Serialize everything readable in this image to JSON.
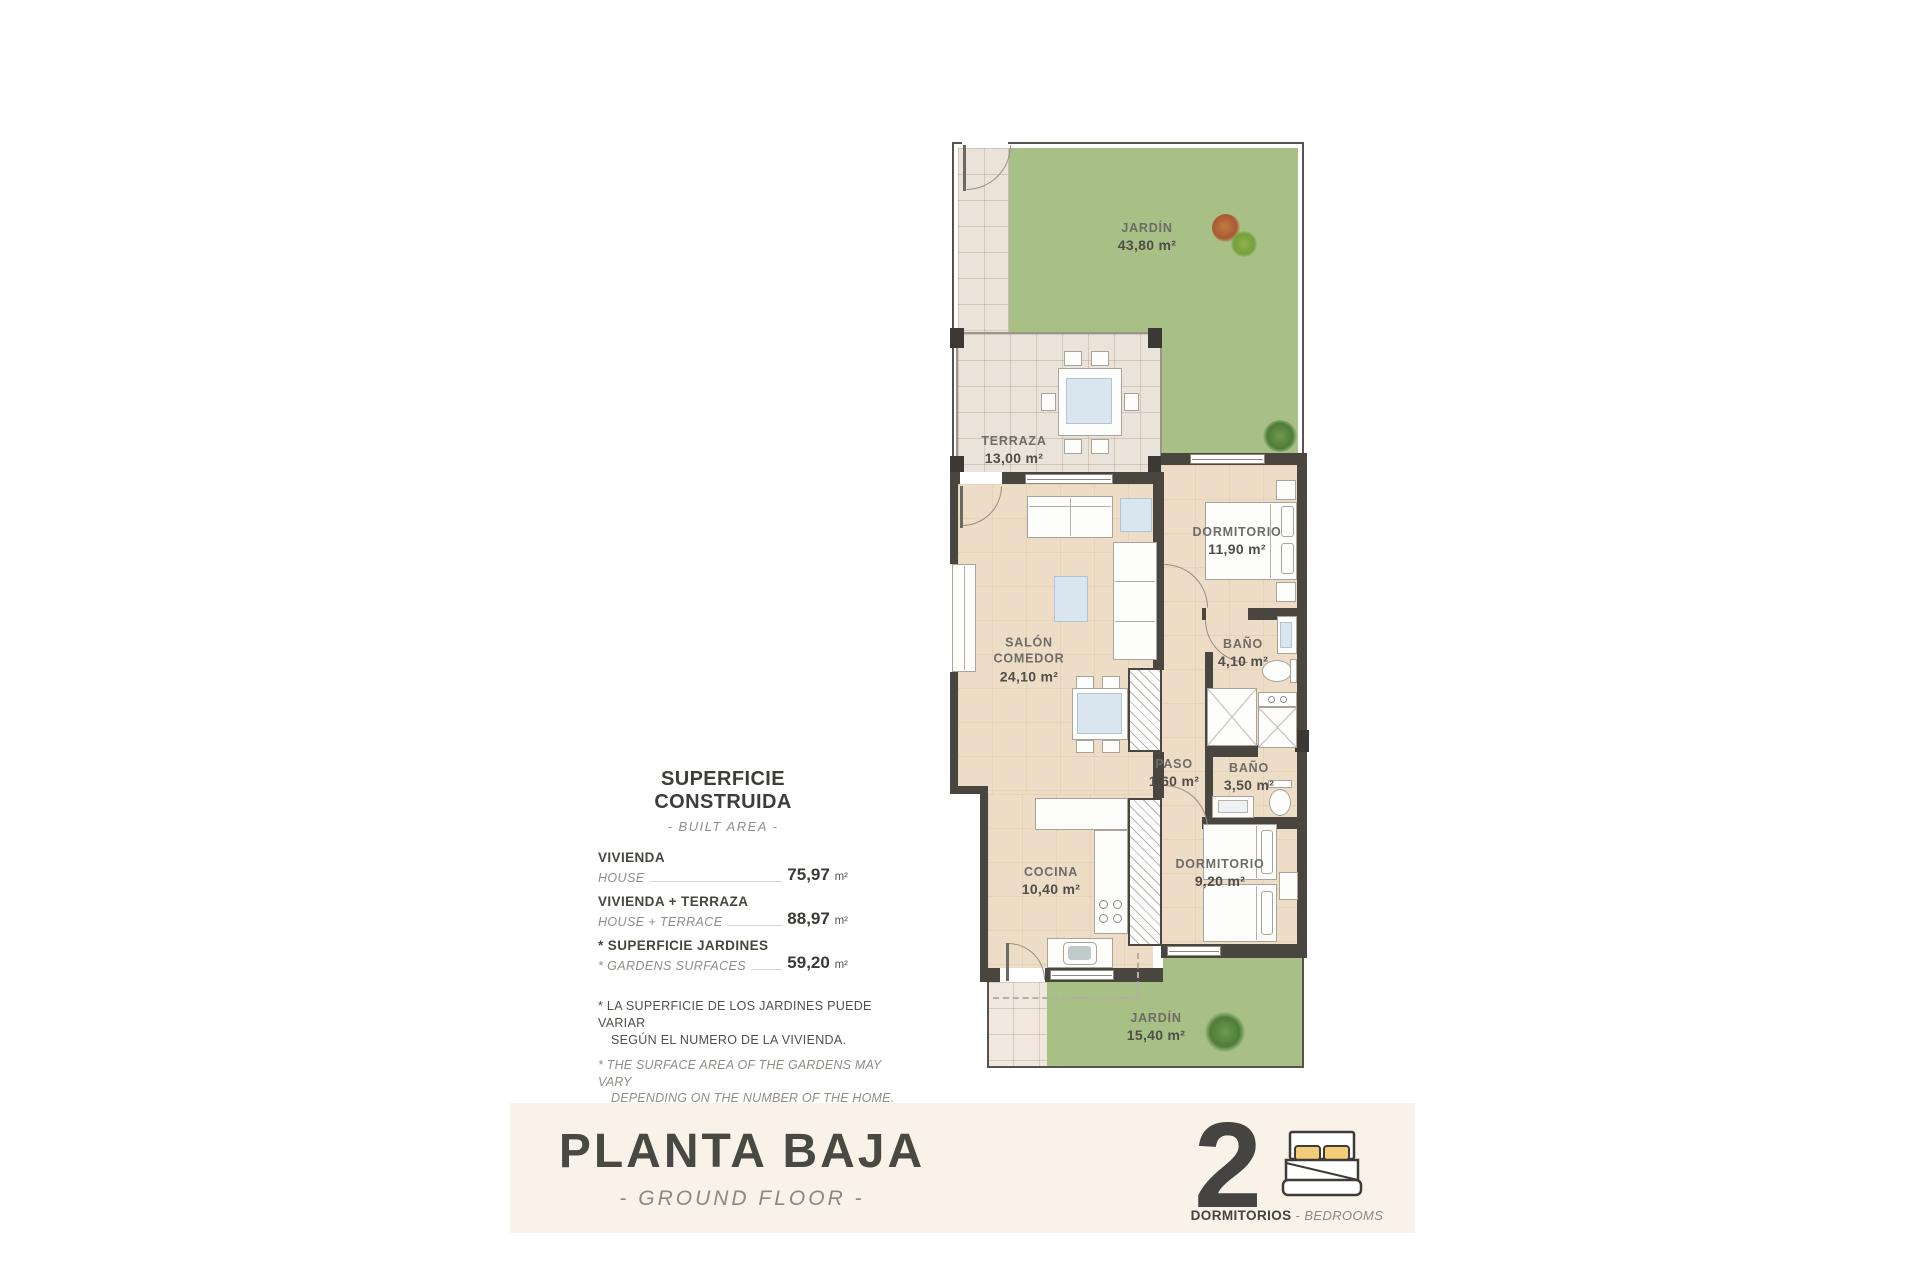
{
  "plan": {
    "rooms": {
      "jardin_top": {
        "name": "JARDÍN",
        "area": "43,80 m²"
      },
      "terraza": {
        "name": "TERRAZA",
        "area": "13,00 m²"
      },
      "salon": {
        "line1": "SALÓN",
        "line2": "COMEDOR",
        "area": "24,10 m²"
      },
      "dormitorio1": {
        "name": "DORMITORIO",
        "area": "11,90 m²"
      },
      "bano1": {
        "name": "BAÑO",
        "area": "4,10 m²"
      },
      "paso": {
        "name": "PASO",
        "area": "1,60 m²"
      },
      "bano2": {
        "name": "BAÑO",
        "area": "3,50 m²"
      },
      "cocina": {
        "name": "COCINA",
        "area": "10,40 m²"
      },
      "dormitorio2": {
        "name": "DORMITORIO",
        "area": "9,20 m²"
      },
      "jardin_bottom": {
        "name": "JARDÍN",
        "area": "15,40 m²"
      }
    }
  },
  "info_panel": {
    "title": "SUPERFICIE CONSTRUIDA",
    "subtitle": "- BUILT AREA -",
    "rows": [
      {
        "label_es": "VIVIENDA",
        "label_en": "HOUSE",
        "value": "75,97",
        "unit": "m²"
      },
      {
        "label_es": "VIVIENDA + TERRAZA",
        "label_en": "HOUSE + TERRACE",
        "value": "88,97",
        "unit": "m²"
      },
      {
        "label_es": "* SUPERFICIE JARDINES",
        "label_en": "* GARDENS SURFACES",
        "value": "59,20",
        "unit": "m²"
      }
    ],
    "note_es_1": "* LA SUPERFICIE DE LOS JARDINES PUEDE VARIAR",
    "note_es_2": "SEGÚN EL NUMERO DE LA VIVIENDA.",
    "note_en_1": "* THE SURFACE AREA OF THE GARDENS MAY VARY",
    "note_en_2": "DEPENDING ON THE NUMBER OF THE HOME."
  },
  "footer": {
    "title": "PLANTA BAJA",
    "subtitle": "- GROUND FLOOR -",
    "bedroom_count": "2",
    "bedrooms_es": "DORMITORIOS",
    "separator": " - ",
    "bedrooms_en": "BEDROOMS"
  },
  "colors": {
    "garden_green": "#a8bf85",
    "interior_floor": "#eddcc6",
    "terrace_tile": "#eae3d9",
    "wall": "#49453f",
    "footer_band": "#f8f2e8",
    "pillow_yellow": "#f2cc77"
  }
}
